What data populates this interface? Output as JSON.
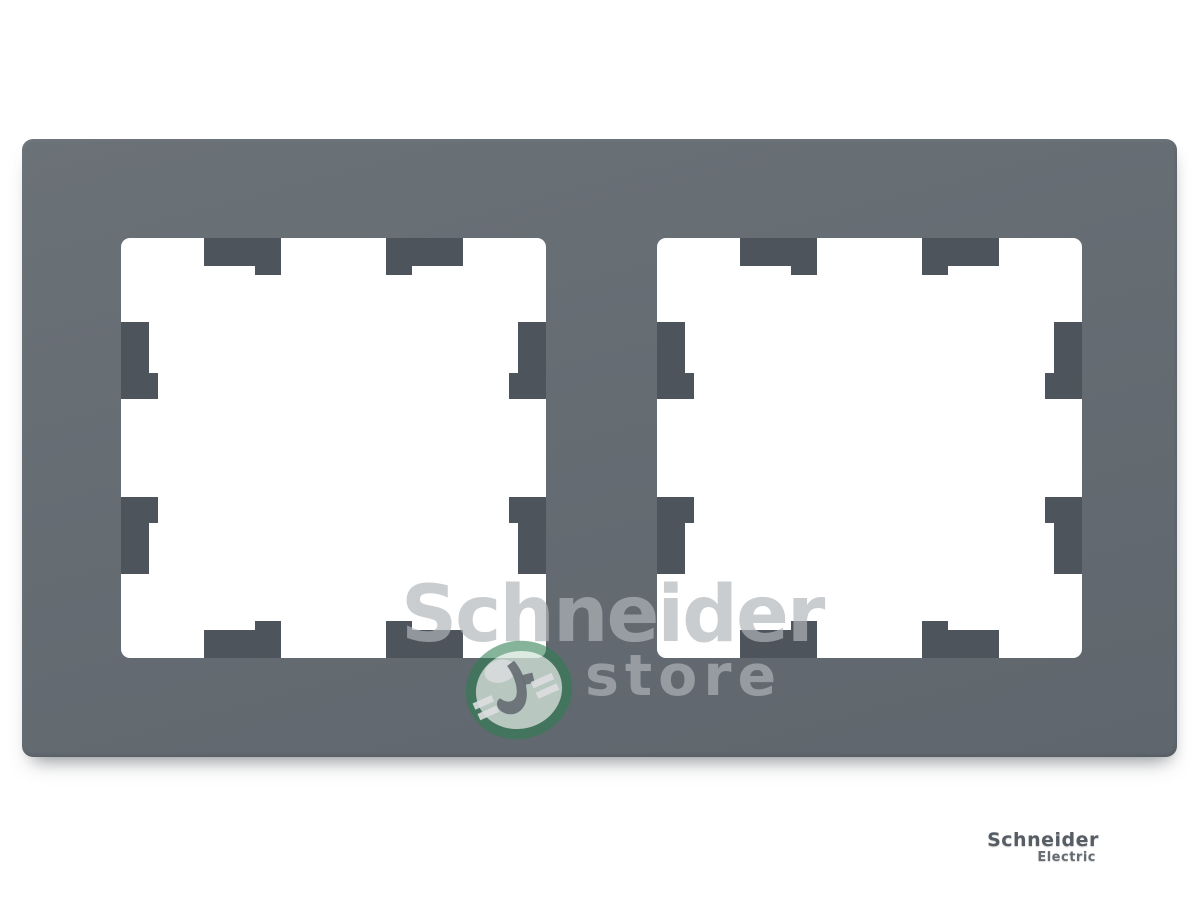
{
  "product": {
    "type": "double-frame-wall-plate-photo",
    "watermark": {
      "line1": "Schneider",
      "line2": "store",
      "logo": "green-leaf-ellipse-logo"
    },
    "embossed_logo": {
      "brand": "Schneider",
      "sub": "Electric"
    }
  },
  "colors": {
    "frame": "#6a7177",
    "frame_dark": "#5f666d",
    "tab": "#4d545b",
    "background": "#ffffff",
    "watermark_text": "#b1b6ba",
    "logo_green": "#2e7d52",
    "embossed_text": "#565d64"
  }
}
